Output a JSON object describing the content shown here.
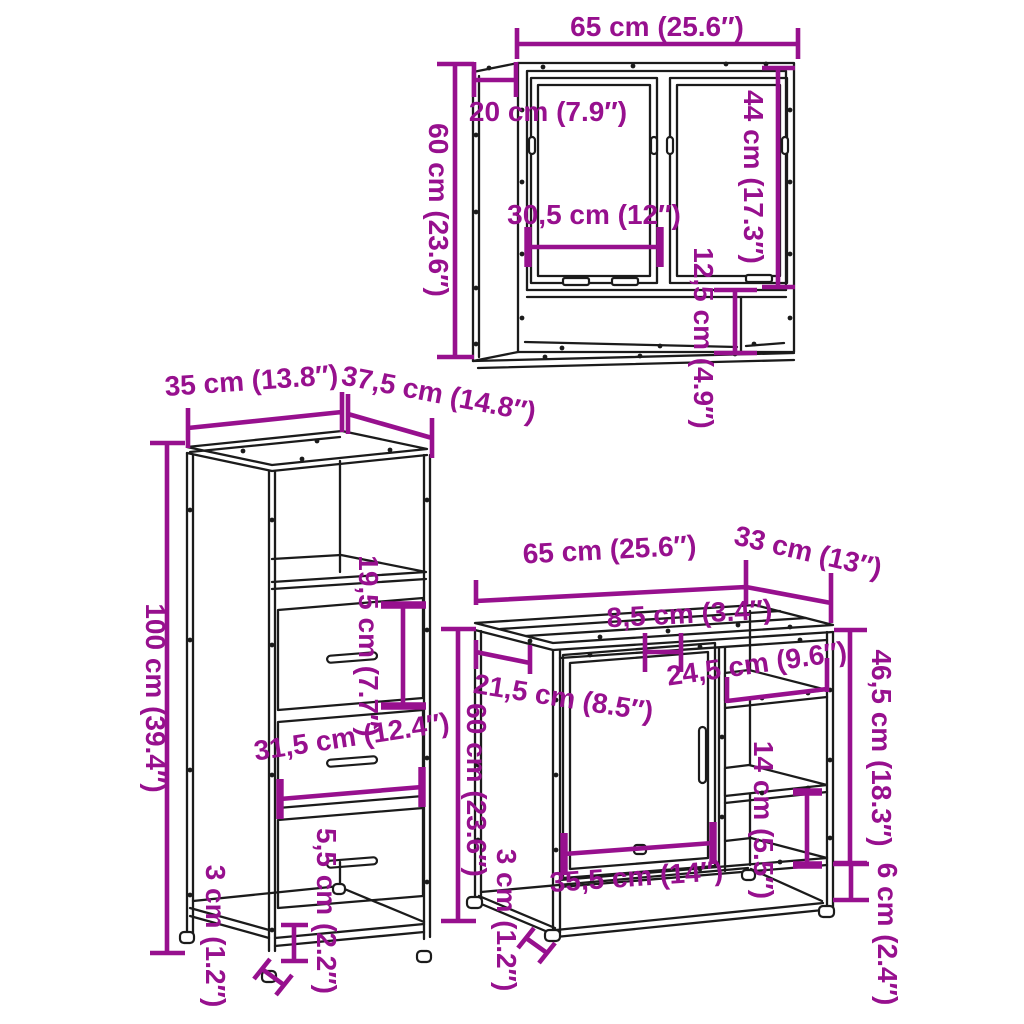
{
  "colors": {
    "dimension": "#97108E",
    "line": "#1b1b1b",
    "background": "#ffffff"
  },
  "mirror_cabinet": {
    "width": "65 cm (25.6″)",
    "depth": "20 cm (7.9″)",
    "height": "60 cm (23.6″)",
    "door_width": "30,5 cm (12″)",
    "door_height": "44 cm (17.3″)",
    "shelf_height": "12,5 cm (4.9″)"
  },
  "tall_cabinet": {
    "width": "35 cm (13.8″)",
    "depth": "37,5 cm (14.8″)",
    "height": "100 cm (39.4″)",
    "drawer_face_height": "19,5 cm (7.7″)",
    "drawer_width": "31,5 cm (12.4″)",
    "base_clearance": "5,5 cm (2.2″)",
    "foot_height": "3 cm (1.2″)"
  },
  "sink_cabinet": {
    "width": "65 cm (25.6″)",
    "depth": "33 cm (13″)",
    "top_cutout_width": "8,5 cm (3.4″)",
    "top_front_depth": "21,5 cm (8.5″)",
    "shelf_width": "24,5 cm (9.6″)",
    "open_section_height": "46,5 cm (18.3″)",
    "height": "60 cm (23.6″)",
    "shelf_spacing": "14 cm (5.5″)",
    "door_width": "35,5 cm (14″)",
    "base_clearance": "6 cm (2.4″)",
    "foot_height": "3 cm (1.2″)"
  }
}
